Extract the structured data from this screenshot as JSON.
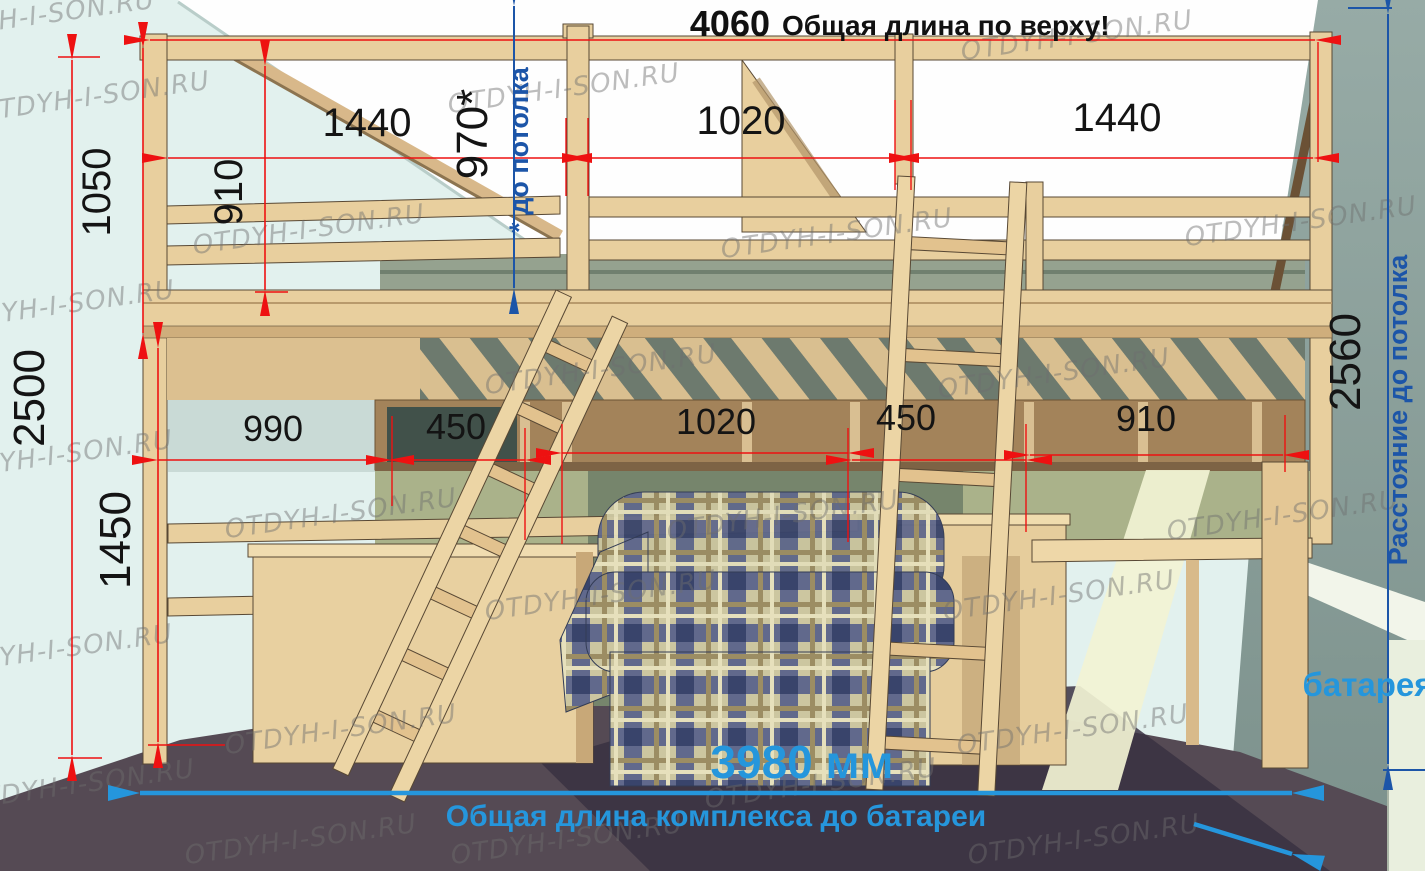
{
  "diagram": {
    "header": {
      "number": "4060",
      "text": "Общая длина по верху!"
    },
    "dimensions": {
      "top_total": "4060",
      "left_height": "1050",
      "rail_height": "910",
      "top_left": "1440",
      "top_center": "1020",
      "top_right": "1440",
      "ceiling_clearance": "970*",
      "total_height": "2500",
      "under_bed_height": "1450",
      "mid_1": "990",
      "mid_2": "450",
      "mid_3": "1020",
      "mid_4": "450",
      "mid_5": "910",
      "right_height": "2560"
    },
    "labels": {
      "ceiling_note": "* до потолка",
      "right_note": "Расстояние до потолка",
      "radiator": "батарея",
      "bottom_total": "3980 мм",
      "bottom_note": "Общая длина комплекса до батареи"
    },
    "watermark": {
      "text": "OTDYH-I-SON.RU"
    },
    "colors": {
      "dimension_red": "#ee1111",
      "annotation_blue_dark": "#1c55a8",
      "annotation_blue_light": "#2596dc",
      "dimension_text": "#141414"
    }
  }
}
